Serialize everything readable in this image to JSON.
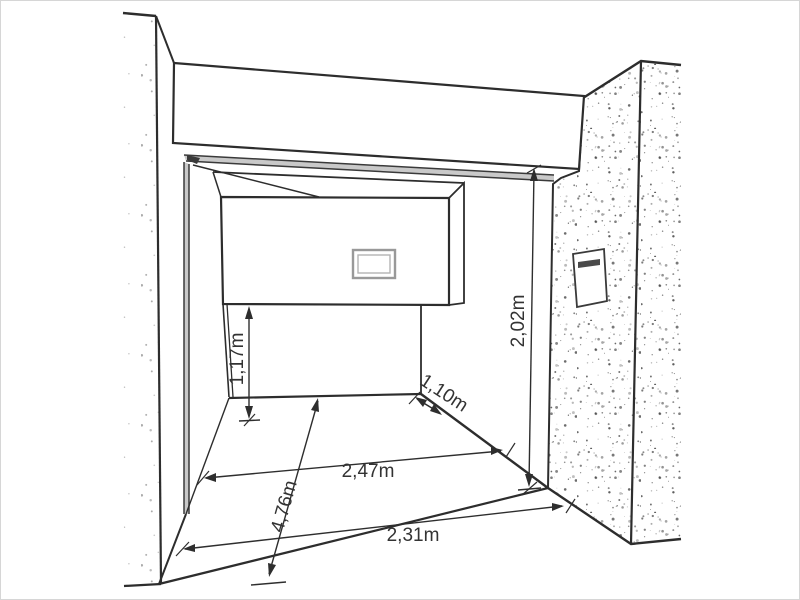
{
  "drawing": {
    "type": "perspective-dimension-drawing",
    "subject": "garage niche with partially open overhead door",
    "unit": "m"
  },
  "dimensions": {
    "panel_to_floor": {
      "label": "1,17m"
    },
    "opening_height": {
      "label": "2,02m"
    },
    "right_return_depth": {
      "label": "1,10m"
    },
    "inner_width": {
      "label": "2,47m"
    },
    "diagonal_depth": {
      "label": "4,76m"
    },
    "front_width": {
      "label": "2,31m"
    }
  },
  "colors": {
    "line": "#2d2d2d",
    "dim_line": "#2e2e2e",
    "dim_text": "#333333",
    "rail_fill": "#c9c9c9",
    "window_frame": "#999999",
    "stipple_left": "#8f8f8f",
    "stipple_right": "#3f3f3f",
    "page_border": "#d6d6d6"
  }
}
